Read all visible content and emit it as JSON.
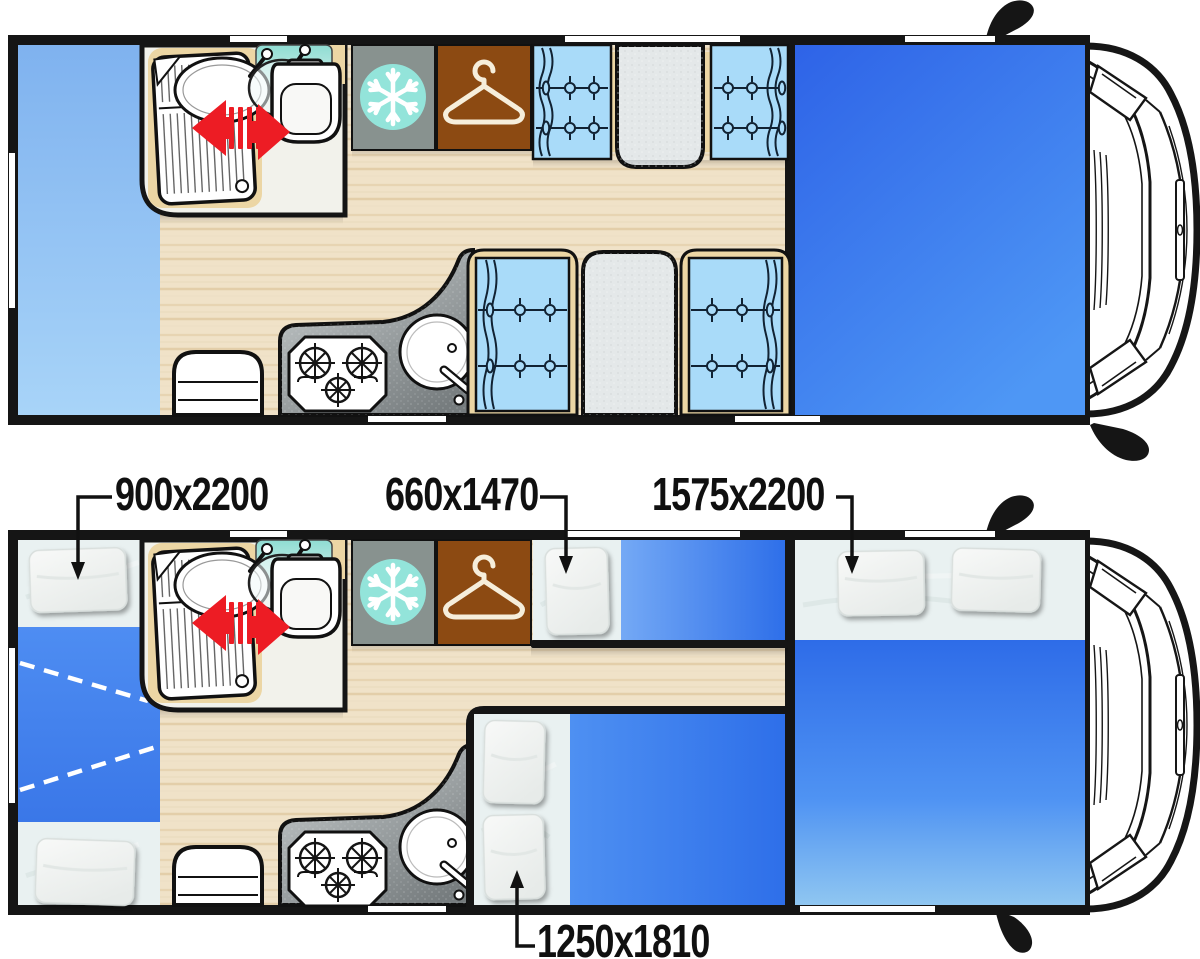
{
  "page": {
    "title": "Motorhome floor plan — day and night layouts"
  },
  "plans": [
    {
      "id": "day",
      "name": "day layout"
    },
    {
      "id": "night",
      "name": "night layout with beds made up"
    }
  ],
  "bed_labels": [
    {
      "id": "rear-bunk-bed",
      "text": "900x2200",
      "width_mm": 900,
      "length_mm": 2200
    },
    {
      "id": "front-dinette-bed",
      "text": "660x1470",
      "width_mm": 660,
      "length_mm": 1470
    },
    {
      "id": "cab-dropdown-bed",
      "text": "1575x2200",
      "width_mm": 1575,
      "length_mm": 2200
    },
    {
      "id": "rear-dinette-bed",
      "text": "1250x1810",
      "width_mm": 1250,
      "length_mm": 1810
    }
  ],
  "icons": [
    "snowflake-icon",
    "hanger-icon",
    "sliding-door-arrow-icon",
    "side-mirror-icon",
    "stove-burners-icon",
    "kitchen-sink-icon",
    "toilet-icon",
    "shower-tray-icon"
  ],
  "palette": {
    "frame": "#151515",
    "wood": "#F0E2C8",
    "wood_grain": "#E3CEA9",
    "day_rear_bed_top": "#7FB2EF",
    "day_rear_bed_bottom": "#A8D4F8",
    "day_cab_bed_dark": "#2E63E7",
    "day_cab_bed_light": "#4E97F5",
    "mattress_blue": "#2E6FE9",
    "mattress_light": "#8FC6F1",
    "sheet": "#E9F1F1",
    "pillow": "#F6F8F7",
    "seat_cushion": "#A9DBF9",
    "trim_tan": "#ECD6A4",
    "table_gray": "#E4E8E9",
    "counter_dark": "#767C7E",
    "counter_light": "#CDD2D3",
    "fridge_gray": "#88928F",
    "freezer_teal": "#93E4DA",
    "wardrobe_brown": "#8C4A12",
    "hanger_cream": "#F6EEDB",
    "slide_arrow_red": "#ED1C24",
    "bathroom_floor": "#F2F2EB",
    "glass_teal": "#8FDCD2"
  }
}
